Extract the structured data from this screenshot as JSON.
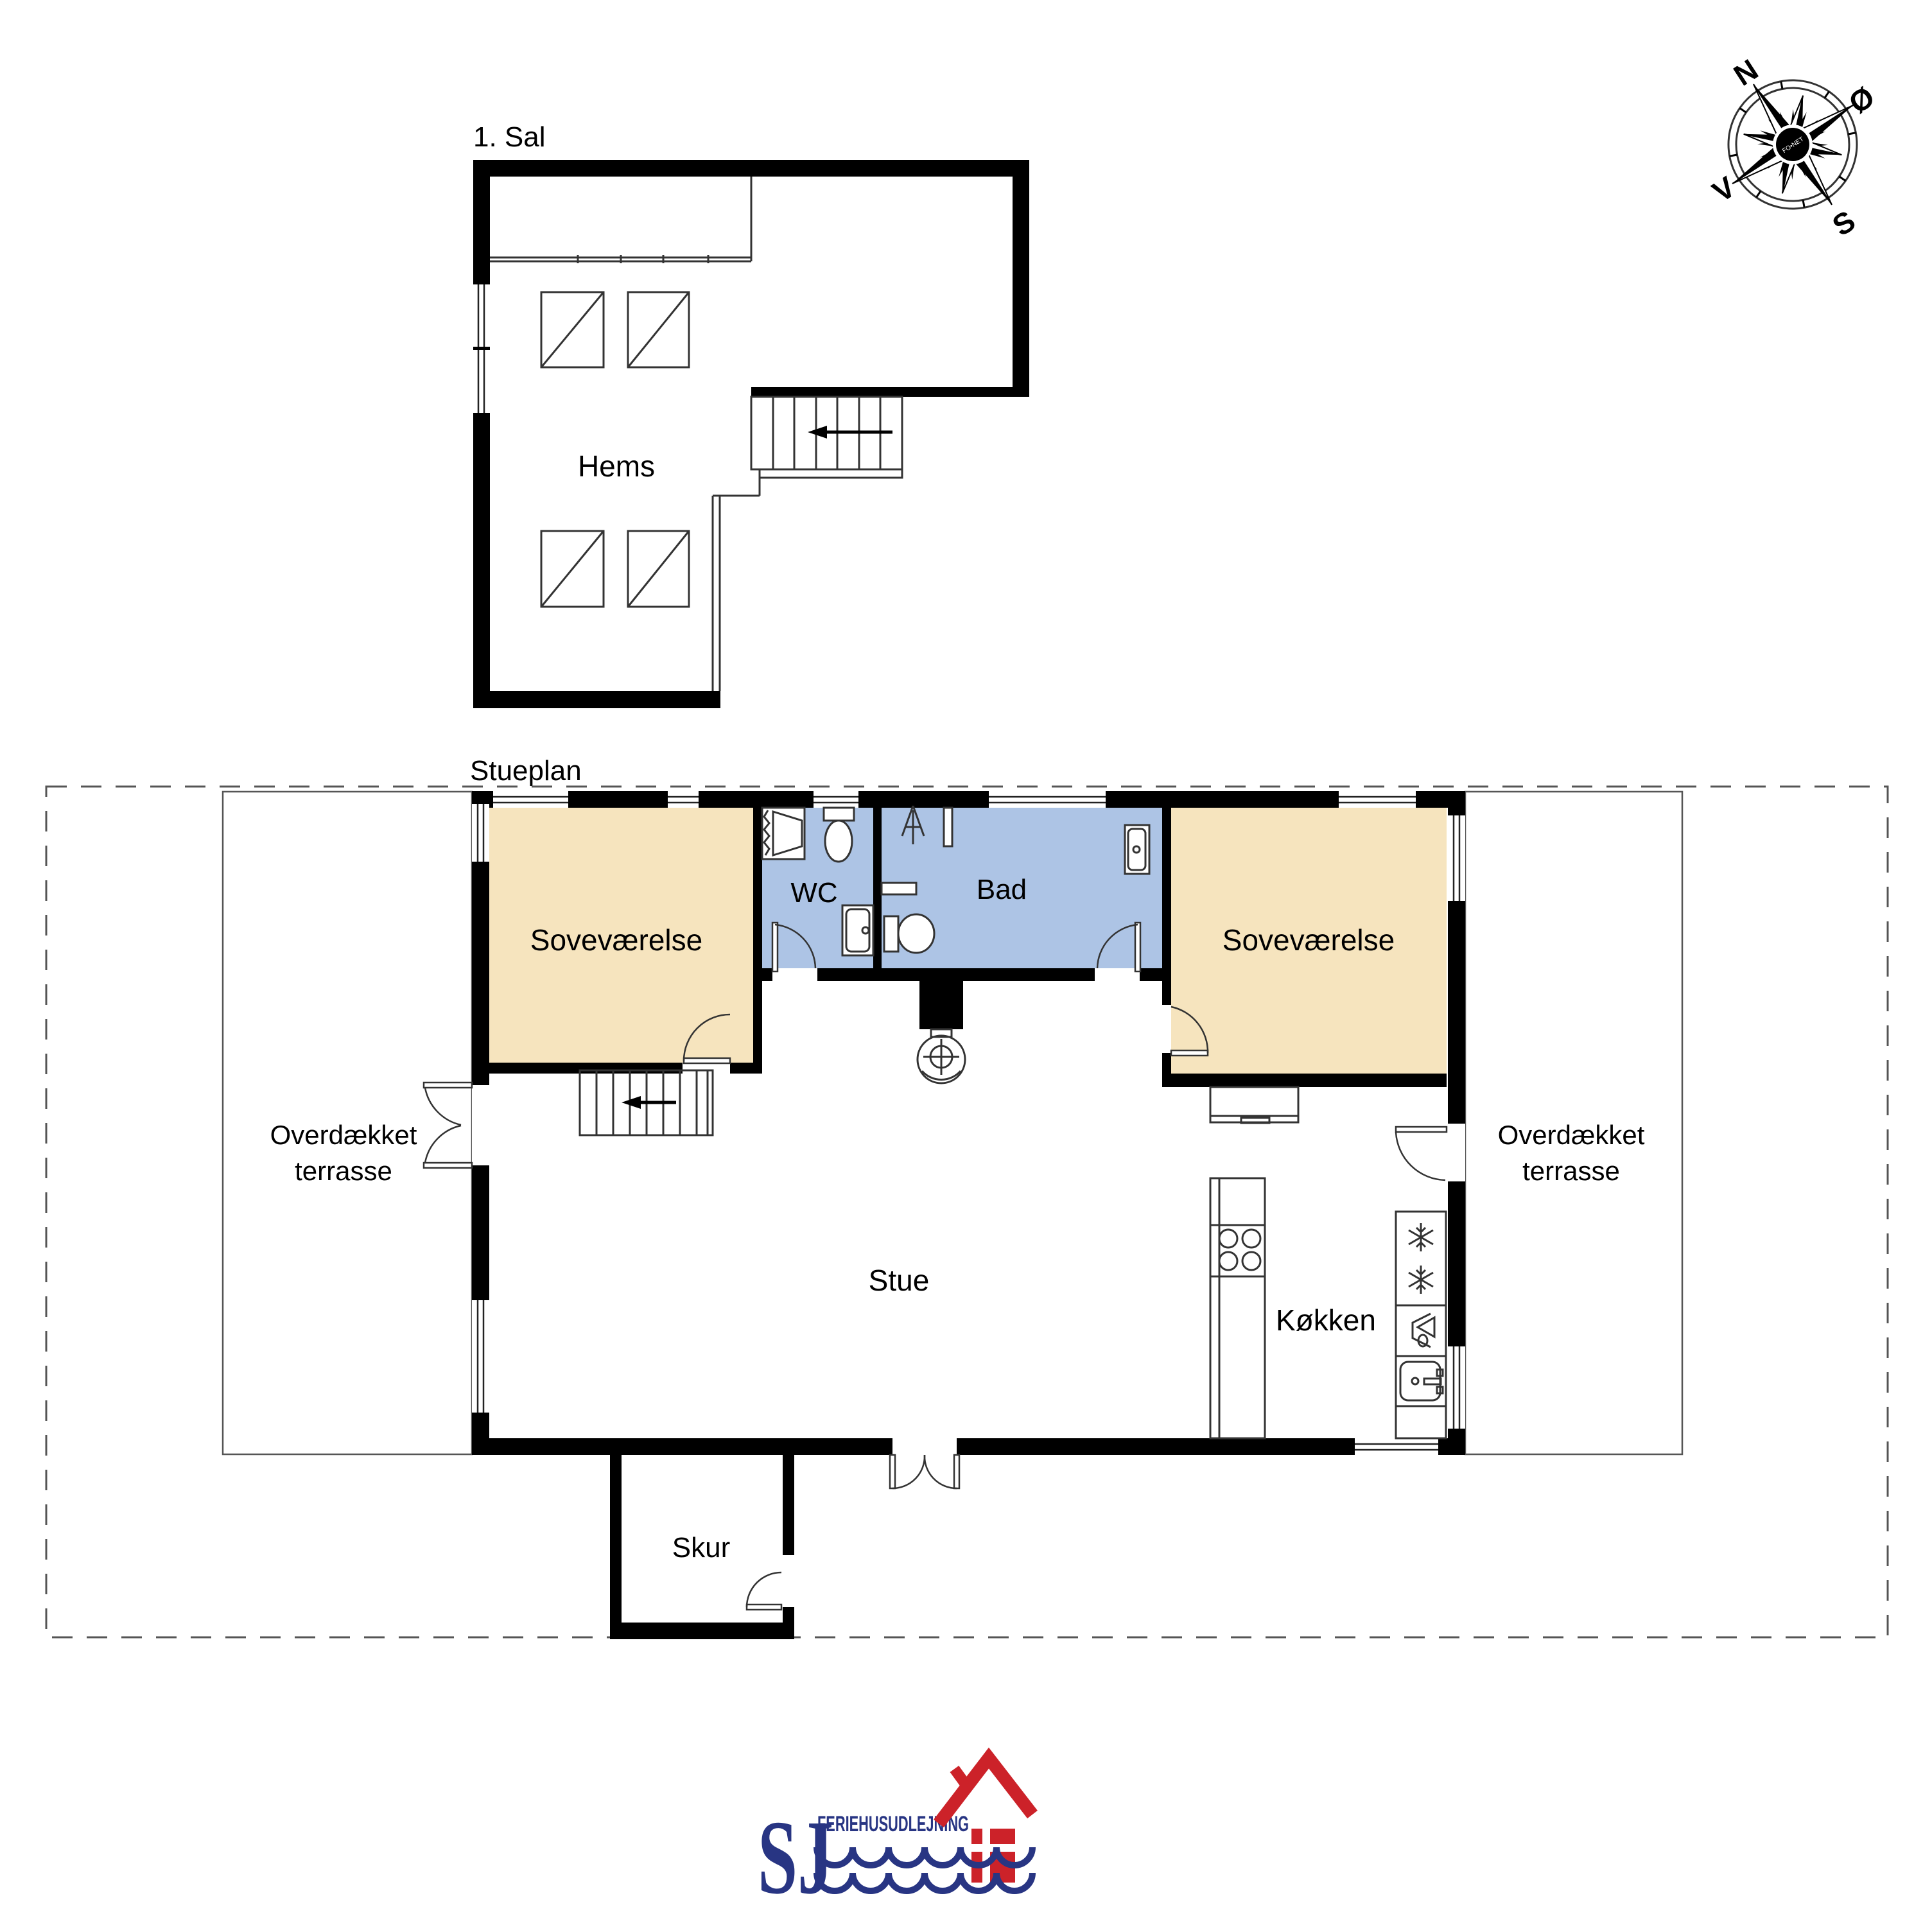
{
  "colors": {
    "bedroom": "#F6E4BE",
    "bathroom": "#ADC4E5",
    "wall": "#000000",
    "logo_navy": "#283583",
    "logo_red": "#CC2229"
  },
  "upper_floor": {
    "title": "1. Sal",
    "rooms": {
      "loft": "Hems"
    }
  },
  "ground_floor": {
    "title": "Stueplan",
    "rooms": {
      "bedroom_left": "Soveværelse",
      "wc": "WC",
      "bath": "Bad",
      "bedroom_right": "Soveværelse",
      "living": "Stue",
      "kitchen": "Køkken",
      "shed": "Skur",
      "terrace_line1": "Overdækket",
      "terrace_line2": "terrasse"
    }
  },
  "compass": {
    "north": "N",
    "east": "Ø",
    "south": "S",
    "west": "V",
    "watermark": "FO•NET"
  },
  "logo": {
    "initials": "SJ",
    "company": "FERIEHUSUDLEJNING"
  }
}
